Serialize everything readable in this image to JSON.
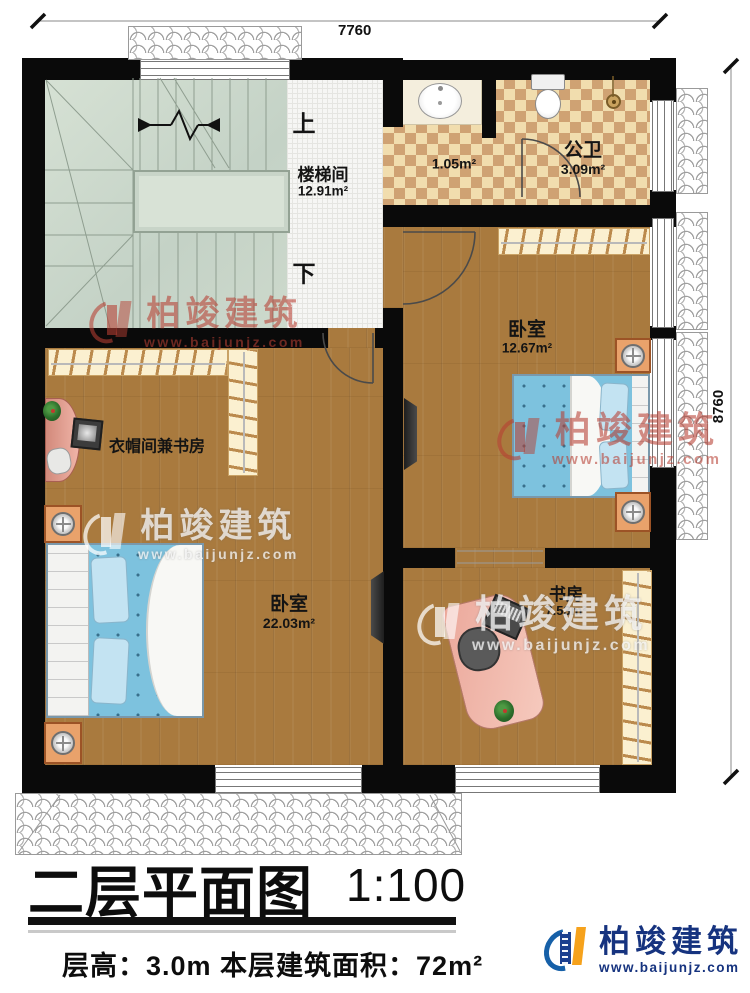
{
  "dimensions": {
    "top": "7760",
    "right": "8760"
  },
  "stairs": {
    "up": "上",
    "down": "下"
  },
  "rooms": {
    "stairwell": {
      "name": "楼梯间",
      "area": "12.91m²"
    },
    "bath_lobby": {
      "area": "1.05m²"
    },
    "public_bath": {
      "name": "公卫",
      "area": "3.09m²"
    },
    "bedroom_right": {
      "name": "卧室",
      "area": "12.67m²"
    },
    "cloakroom_study": {
      "name": "衣帽间兼书房"
    },
    "bedroom_left": {
      "name": "卧室",
      "area": "22.03m²"
    },
    "study": {
      "name": "书房",
      "area": "7.53m²"
    }
  },
  "watermark": {
    "brand": "柏竣建筑",
    "url": "www.baijunjz.com"
  },
  "footer": {
    "plan_title": "二层平面图",
    "scale": "1:100",
    "floor_info": "层高：3.0m  本层建筑面积：72m²",
    "brand": "柏竣建筑",
    "url": "www.baijunjz.com"
  },
  "colors": {
    "accent_blue": "#1b3f8f",
    "accent_orange": "#f6a21c",
    "watermark_red": "#b73e32"
  }
}
